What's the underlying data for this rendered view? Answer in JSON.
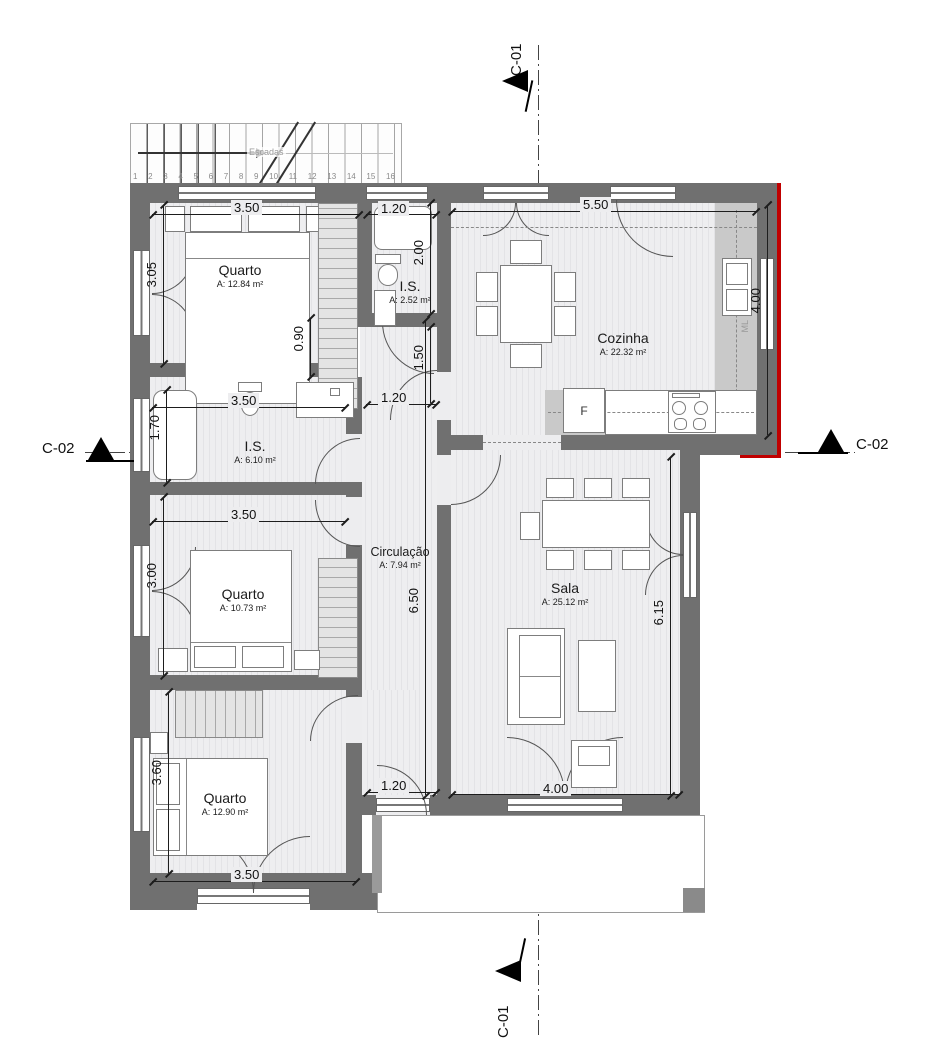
{
  "colors": {
    "wall": "#707070",
    "wall_light": "#c9c9c9",
    "floor": "#ededef",
    "accent_red": "#c00000"
  },
  "rooms": [
    {
      "id": "quarto-1",
      "name": "Quarto",
      "area": "A: 12.84 m²"
    },
    {
      "id": "is-1",
      "name": "I.S.",
      "area": "A: 2.52 m²"
    },
    {
      "id": "cozinha",
      "name": "Cozinha",
      "area": "A: 22.32 m²"
    },
    {
      "id": "is-2",
      "name": "I.S.",
      "area": "A: 6.10 m²"
    },
    {
      "id": "quarto-2",
      "name": "Quarto",
      "area": "A: 10.73 m²"
    },
    {
      "id": "circulacao",
      "name": "Circulação",
      "area": "A: 7.94 m²"
    },
    {
      "id": "sala",
      "name": "Sala",
      "area": "A: 25.12 m²"
    },
    {
      "id": "quarto-3",
      "name": "Quarto",
      "area": "A: 12.90 m²"
    }
  ],
  "dimensions": {
    "q1_width": "3.50",
    "is1_width": "1.20",
    "cozinha_width": "5.50",
    "is1_depth": "2.00",
    "cozinha_height": "4.00",
    "hall_gap": "0.90",
    "hall_upper": "1.50",
    "hall_width_mid": "1.20",
    "q1_height": "3.05",
    "is2_height": "1.70",
    "is2_width": "3.50",
    "q2_height": "3.00",
    "q2_width": "3.50",
    "circ_height": "6.50",
    "sala_height": "6.15",
    "q3_height": "3.60",
    "hall_width_bottom": "1.20",
    "sala_width": "4.00",
    "q3_width": "3.50"
  },
  "section_markers": {
    "top": "C-01",
    "bottom": "C-01",
    "left": "C-02",
    "right": "C-02"
  },
  "stairs": {
    "label": "Escadas",
    "steps": [
      "1",
      "2",
      "3",
      "4",
      "5",
      "6",
      "7",
      "8",
      "9",
      "10",
      "11",
      "12",
      "13",
      "14",
      "15",
      "16"
    ]
  },
  "labels": {
    "fridge": "F",
    "washing_machine": "ML"
  }
}
